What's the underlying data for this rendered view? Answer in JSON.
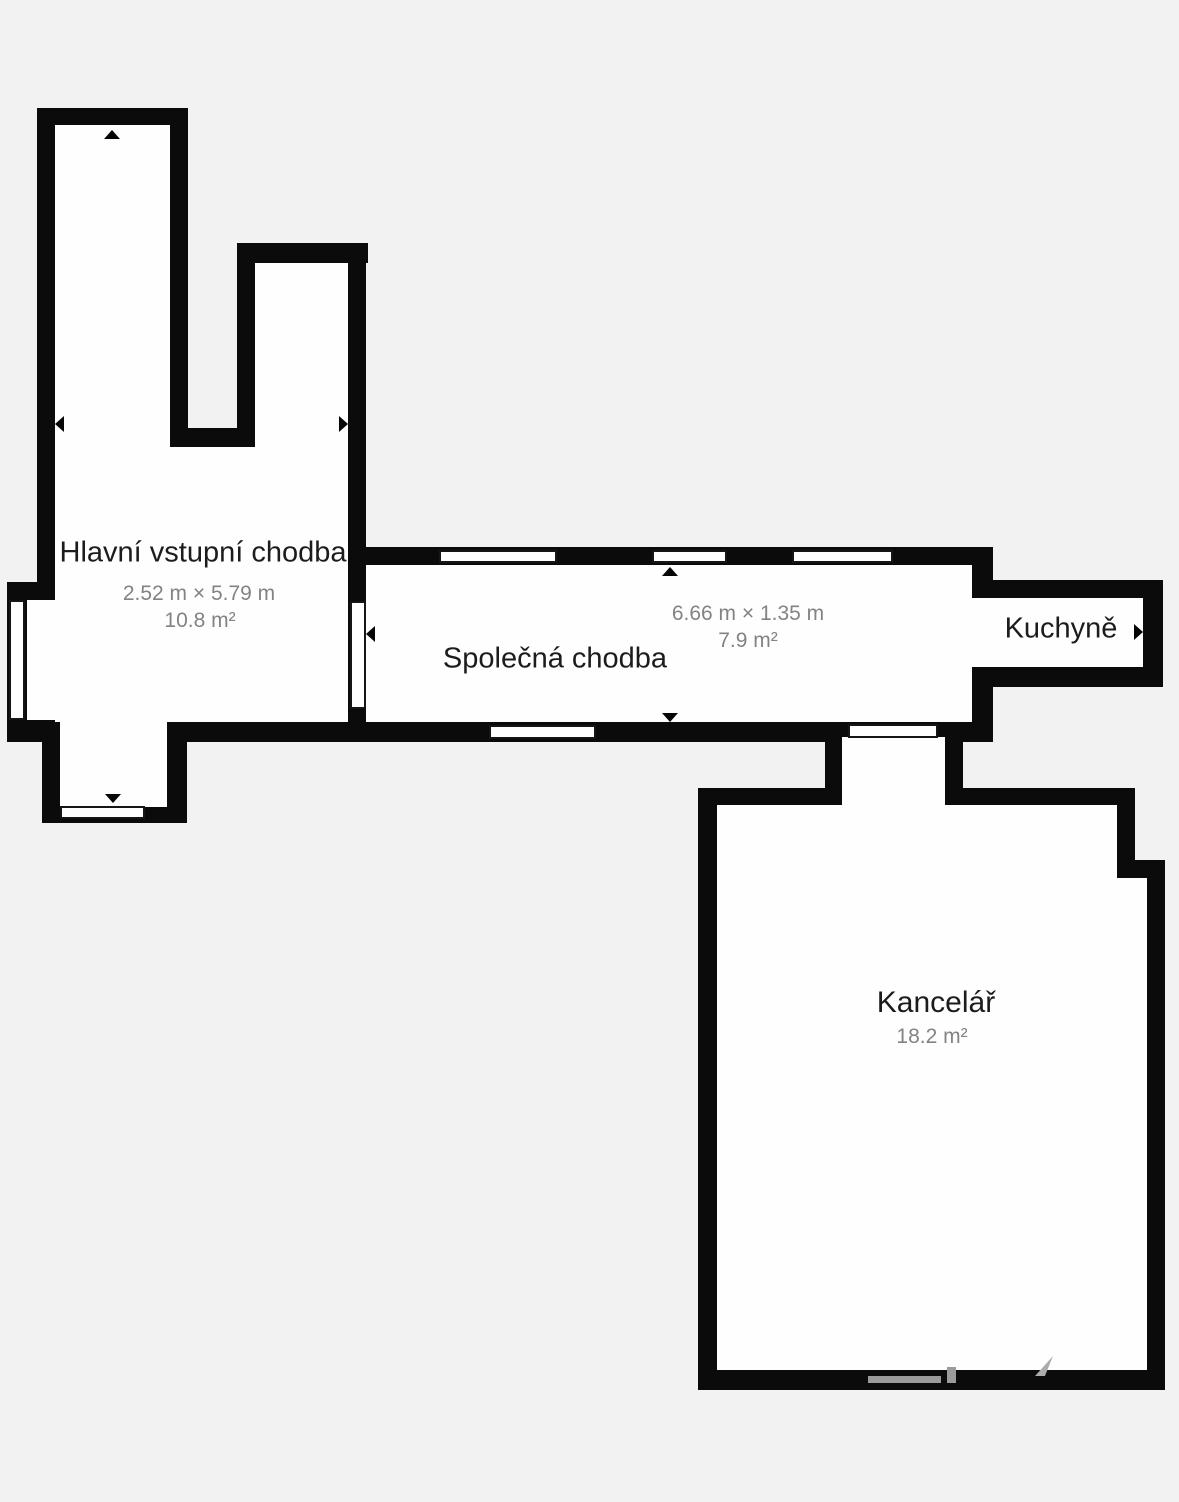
{
  "floorplan": {
    "rooms": [
      {
        "id": "hlavni",
        "name": "Hlavní vstupní chodba",
        "dimensions": "2.52 m × 5.79 m",
        "area": "10.8 m²"
      },
      {
        "id": "spolecna",
        "name": "Společná chodba",
        "dimensions": "6.66 m × 1.35 m",
        "area": "7.9 m²"
      },
      {
        "id": "kuchyne",
        "name": "Kuchyně"
      },
      {
        "id": "kancelar",
        "name": "Kancelář",
        "area": "18.2 m²"
      }
    ],
    "icons": {
      "direction_markers": [
        "arrow-up",
        "arrow-left",
        "arrow-right",
        "arrow-down"
      ]
    },
    "colors": {
      "background": "#f3f2f2",
      "wall": "#0b0b0b",
      "room_fill": "#fefefe",
      "label_text": "#1c1c1c",
      "dimension_text": "#838383",
      "watermark": "#9b9b9b"
    }
  }
}
